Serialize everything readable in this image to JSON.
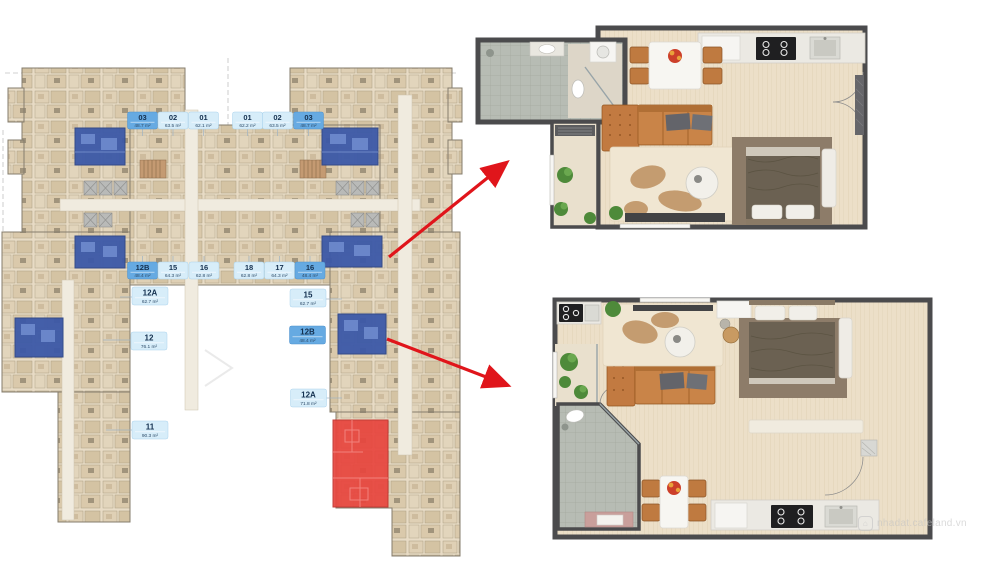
{
  "site_plan": {
    "top_row": [
      {
        "unit": "03",
        "area": "48.7 m²",
        "highlighted": true
      },
      {
        "unit": "02",
        "area": "63.5 m²",
        "highlighted": false
      },
      {
        "unit": "01",
        "area": "62.1 m²",
        "highlighted": false
      },
      {
        "unit": "01",
        "area": "62.2 m²",
        "highlighted": false
      },
      {
        "unit": "02",
        "area": "63.5 m²",
        "highlighted": false
      },
      {
        "unit": "03",
        "area": "48.7 m²",
        "highlighted": true
      }
    ],
    "mid_row": [
      {
        "unit": "12B",
        "area": "48.4 m²",
        "highlighted": true
      },
      {
        "unit": "15",
        "area": "64.3 m²",
        "highlighted": false
      },
      {
        "unit": "16",
        "area": "62.8 m²",
        "highlighted": false
      },
      {
        "unit": "18",
        "area": "62.8 m²",
        "highlighted": false
      },
      {
        "unit": "17",
        "area": "64.3 m²",
        "highlighted": false
      },
      {
        "unit": "16",
        "area": "48.4 m²",
        "highlighted": true
      }
    ],
    "standalone": [
      {
        "unit": "12A",
        "area": "62.7 m²",
        "highlighted": false
      },
      {
        "unit": "15",
        "area": "62.7 m²",
        "highlighted": false
      },
      {
        "unit": "12B",
        "area": "48.4 m²",
        "highlighted": true
      },
      {
        "unit": "12",
        "area": "76.1 m²",
        "highlighted": false
      },
      {
        "unit": "12A",
        "area": "71.8 m²",
        "highlighted": false
      },
      {
        "unit": "11",
        "area": "90.3 m²",
        "highlighted": false
      }
    ]
  },
  "watermark": {
    "text": "nhadat.cafeland.vn",
    "icon": "home-icon"
  },
  "colors": {
    "label_bg": "#d7edf9",
    "label_selected_bg": "#66aae2",
    "label_text": "#14304f",
    "highlight_blue": "#3c59a8",
    "highlight_red": "#e8453e",
    "arrow_red": "#e0151b",
    "wall_gray": "#4b4b4d",
    "floor_beige": "#ecdfc8",
    "tile_gray": "#b7bcb4"
  }
}
